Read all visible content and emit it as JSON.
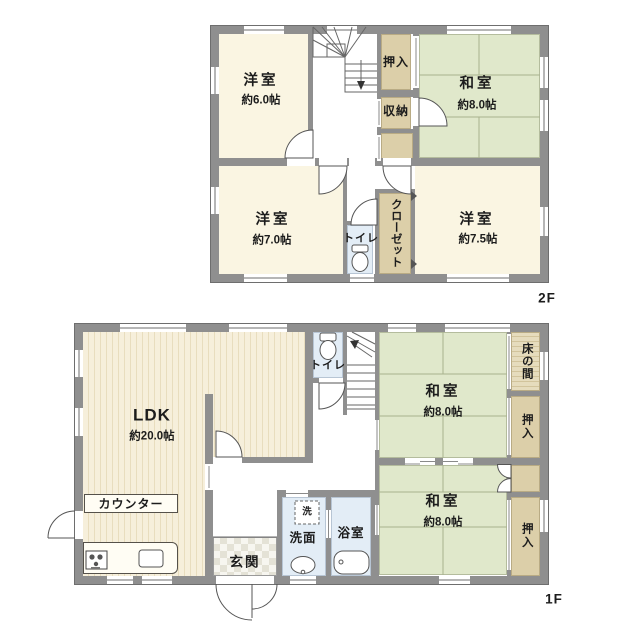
{
  "floors": {
    "f2": {
      "label": "2F",
      "rooms": {
        "western6": {
          "name": "洋室",
          "size": "約6.0帖"
        },
        "japanese8": {
          "name": "和室",
          "size": "約8.0帖"
        },
        "western7": {
          "name": "洋室",
          "size": "約7.0帖"
        },
        "western75": {
          "name": "洋室",
          "size": "約7.5帖"
        },
        "oshiire": {
          "name": "押入"
        },
        "shunou": {
          "name": "収納"
        },
        "toilet": {
          "name": "トイレ"
        },
        "closet": {
          "name": "クローゼット"
        }
      }
    },
    "f1": {
      "label": "1F",
      "rooms": {
        "ldk": {
          "name": "LDK",
          "size": "約20.0帖"
        },
        "counter": {
          "name": "カウンター"
        },
        "japanese8_north": {
          "name": "和室",
          "size": "約8.0帖"
        },
        "japanese8_south": {
          "name": "和室",
          "size": "約8.0帖"
        },
        "tokonoma": {
          "name": "床の間"
        },
        "oshiire_north": {
          "name": "押入"
        },
        "oshiire_south": {
          "name": "押入"
        },
        "toilet": {
          "name": "トイレ"
        },
        "genkan": {
          "name": "玄関"
        },
        "senmen": {
          "name": "洗面"
        },
        "bath": {
          "name": "浴室"
        },
        "laundry": {
          "name": "洗"
        }
      }
    }
  },
  "colors": {
    "wall": "#8f8f8f",
    "western_room": "#faf5e2",
    "tatami": "#e0e8cb",
    "closet_tan": "#dccfa9",
    "wet_blue": "#e3edf6",
    "ldk_stripe": "#e8ddbe"
  }
}
